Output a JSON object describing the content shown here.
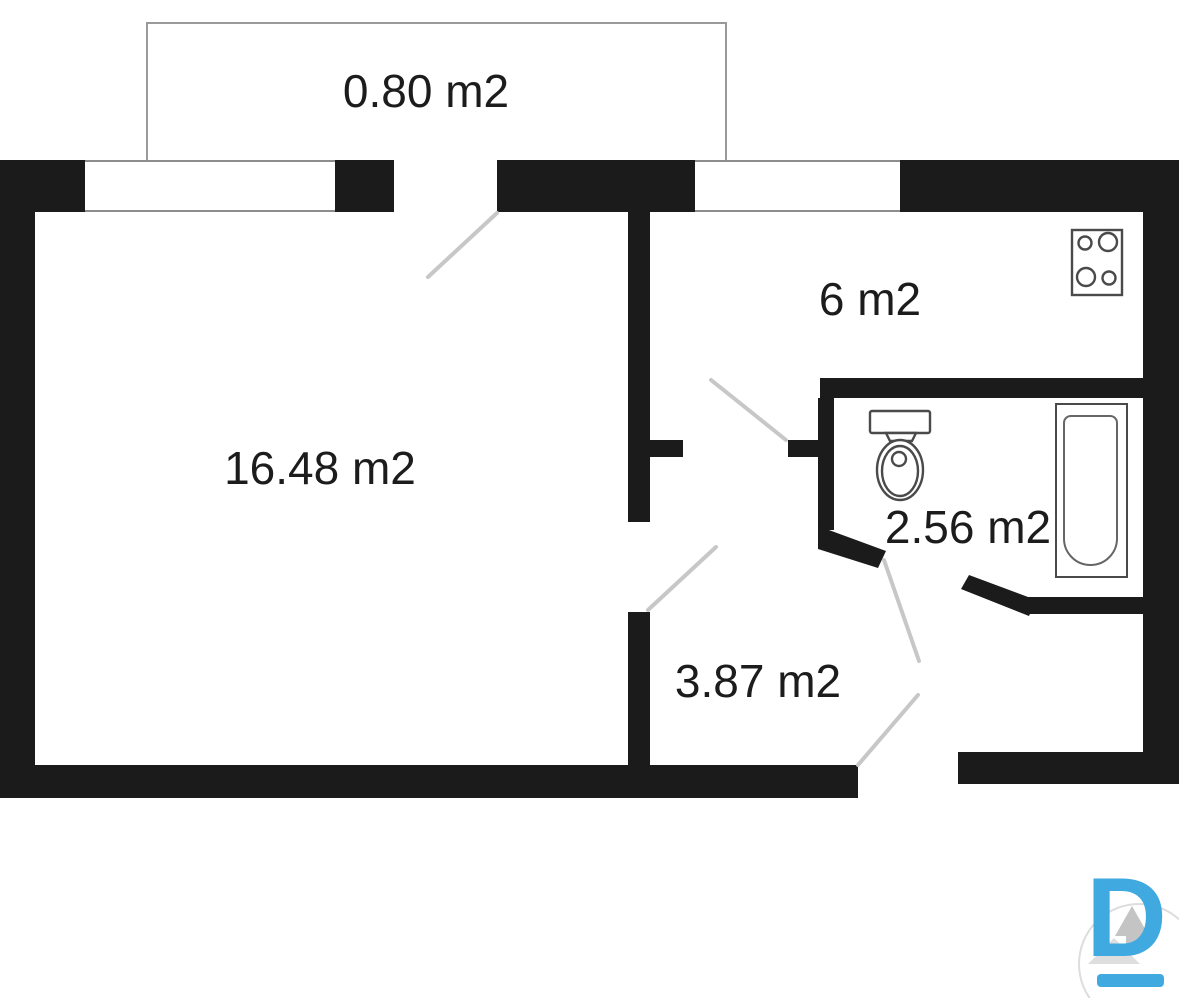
{
  "rooms": {
    "balcony": {
      "label": "0.80 m2"
    },
    "living": {
      "label": "16.48 m2"
    },
    "kitchen": {
      "label": "6 m2"
    },
    "bathroom": {
      "label": "2.56 m2"
    },
    "hallway": {
      "label": "3.87 m2"
    }
  },
  "fixtures": {
    "stove": "stove-icon",
    "toilet": "toilet-icon",
    "bathtub": "bathtub-icon"
  },
  "logo": {
    "letter": "D"
  },
  "colors": {
    "wall": "#1b1b1b",
    "door_swing": "#c7c7c7",
    "fixture_outline": "#4a4a4a",
    "balcony_outline": "#9a9a9a",
    "logo_blue": "#3fa9e0",
    "logo_gray": "#c4c4c4"
  }
}
